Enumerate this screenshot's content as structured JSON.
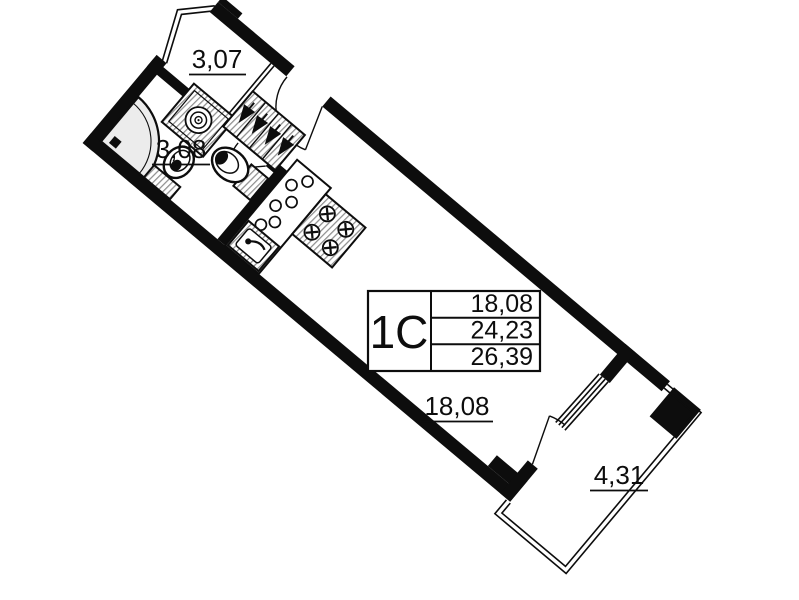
{
  "plan": {
    "type": "apartment_floor_plan",
    "unit": {
      "type_label": "1С",
      "areas": {
        "living": "18,08",
        "total": "24,23",
        "total_with_balcony": "26,39"
      }
    },
    "rooms": [
      {
        "id": "balcony-upper",
        "label": "3,07"
      },
      {
        "id": "bathroom",
        "label": "3,08"
      },
      {
        "id": "living-room",
        "label": "18,08"
      },
      {
        "id": "balcony-lower",
        "label": "4,31"
      }
    ],
    "fixtures": [
      "washing-machine-icon",
      "shower-icon",
      "toilet-icon",
      "washbasin-icon",
      "wardrobe-hangers-icon",
      "kitchen-counter-icon",
      "stove-icon",
      "kitchen-sink-icon",
      "window-icon",
      "door-swing-icon"
    ],
    "colors": {
      "wall": "#0d0d0d",
      "background": "#ffffff",
      "hatch_line": "#8f8f8f",
      "shower_fill": "#ececec"
    }
  }
}
